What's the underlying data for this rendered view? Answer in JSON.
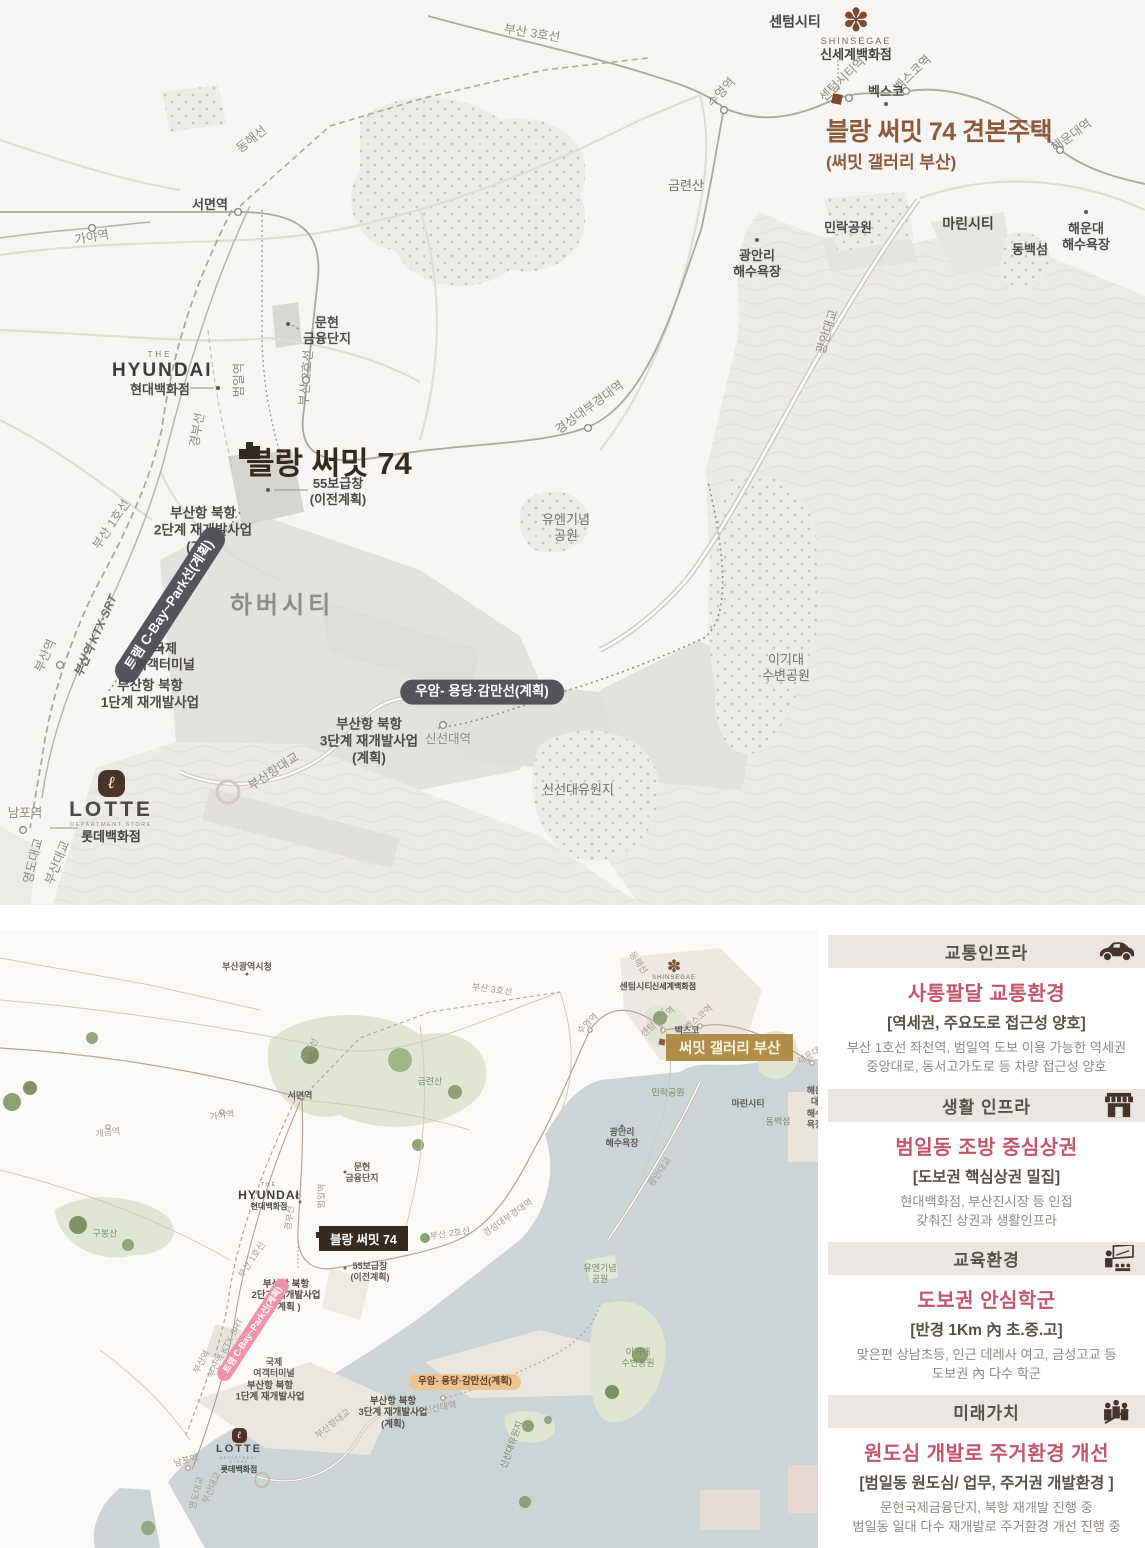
{
  "top_map": {
    "model_house": {
      "title": "블랑 써밋 74 견본주택",
      "subtitle": "(써밋 갤러리 부산)"
    },
    "summit_title": "블랑 써밋 74",
    "shinsegae": {
      "flower": "✽",
      "en": "SHINSEGAE",
      "kr": "신세계백화점"
    },
    "hyundai": {
      "the": "THE",
      "en": "HYUNDAI",
      "kr": "현대백화점"
    },
    "lotte": {
      "mark": "ℓ",
      "en": "LOTTE",
      "sub": "DEPARTMENT STORE",
      "kr": "롯데백화점"
    },
    "labels": [
      {
        "t": "부산 3호선",
        "x": 532,
        "y": 34,
        "c": "line",
        "r": 9
      },
      {
        "t": "수영역",
        "x": 722,
        "y": 93,
        "c": "st",
        "r": -48
      },
      {
        "t": "동해선",
        "x": 252,
        "y": 140,
        "c": "line",
        "r": -38
      },
      {
        "t": "센텀시티",
        "x": 795,
        "y": 22,
        "c": "place"
      },
      {
        "t": "센텀시티역",
        "x": 843,
        "y": 80,
        "c": "st",
        "r": -44
      },
      {
        "t": "벡스코역",
        "x": 913,
        "y": 74,
        "c": "st",
        "r": -44
      },
      {
        "t": "벡스코",
        "x": 886,
        "y": 92,
        "c": "place-sm"
      },
      {
        "t": "해운대역",
        "x": 1072,
        "y": 136,
        "c": "st",
        "r": -36
      },
      {
        "t": "가야역",
        "x": 92,
        "y": 238,
        "c": "st",
        "r": -10
      },
      {
        "t": "서면역",
        "x": 210,
        "y": 205,
        "c": "place-sm"
      },
      {
        "t": "금련산",
        "x": 686,
        "y": 186,
        "c": "park"
      },
      {
        "t": "민락공원",
        "x": 848,
        "y": 228,
        "c": "place-sm"
      },
      {
        "t": "광안리\n해수욕장",
        "x": 757,
        "y": 264,
        "c": "place-sm"
      },
      {
        "t": "마린시티",
        "x": 968,
        "y": 224,
        "c": "place"
      },
      {
        "t": "동백섬",
        "x": 1030,
        "y": 250,
        "c": "place-sm"
      },
      {
        "t": "해운대\n해수욕장",
        "x": 1086,
        "y": 237,
        "c": "place-sm"
      },
      {
        "t": "광안대교",
        "x": 828,
        "y": 332,
        "c": "line",
        "r": -73
      },
      {
        "t": "문현\n금융단지",
        "x": 327,
        "y": 331,
        "c": "place-sm"
      },
      {
        "t": "부산 2호선",
        "x": 307,
        "y": 378,
        "c": "line",
        "r": -85
      },
      {
        "t": "범일역",
        "x": 240,
        "y": 380,
        "c": "st",
        "r": -90
      },
      {
        "t": "경부선",
        "x": 198,
        "y": 430,
        "c": "line",
        "r": -80
      },
      {
        "t": "경성대부경대역",
        "x": 590,
        "y": 408,
        "c": "st",
        "r": -36
      },
      {
        "t": "55보급창\n(이전계획)",
        "x": 338,
        "y": 492,
        "c": "place-sm"
      },
      {
        "t": "부산항 북항\n2단계 재개발사업\n(계획)",
        "x": 203,
        "y": 531,
        "c": "proj"
      },
      {
        "t": "부산 1호선",
        "x": 112,
        "y": 525,
        "c": "line",
        "r": -56
      },
      {
        "t": "트램 C-Bay~Park선(계획)",
        "x": 170,
        "y": 605,
        "c": "pill-dark",
        "r": -57,
        "n": "tram-line-pill"
      },
      {
        "t": "하버시티",
        "x": 282,
        "y": 606,
        "c": "place-lg"
      },
      {
        "t": "국제\n여객터미널",
        "x": 165,
        "y": 657,
        "c": "place-sm"
      },
      {
        "t": "부산항 북항\n1단계 재개발사업",
        "x": 150,
        "y": 695,
        "c": "proj"
      },
      {
        "t": "부산역 KTX·SRT",
        "x": 96,
        "y": 636,
        "c": "st-i",
        "r": -66
      },
      {
        "t": "부산역",
        "x": 46,
        "y": 656,
        "c": "st",
        "r": -66
      },
      {
        "t": "유엔기념\n공원",
        "x": 566,
        "y": 528,
        "c": "park"
      },
      {
        "t": "이기대\n수변공원",
        "x": 786,
        "y": 668,
        "c": "park"
      },
      {
        "t": "우암- 용당·감만선(계획)",
        "x": 482,
        "y": 692,
        "c": "pill-dark",
        "n": "uam-line-pill"
      },
      {
        "t": "부산항 북항\n3단계 재개발사업\n(계획)",
        "x": 369,
        "y": 742,
        "c": "proj"
      },
      {
        "t": "신선대역",
        "x": 448,
        "y": 740,
        "c": "st"
      },
      {
        "t": "신선대유원지",
        "x": 578,
        "y": 790,
        "c": "park"
      },
      {
        "t": "남포역",
        "x": 25,
        "y": 814,
        "c": "st"
      },
      {
        "t": "영도대교",
        "x": 34,
        "y": 861,
        "c": "st",
        "r": -76
      },
      {
        "t": "부산대교",
        "x": 58,
        "y": 863,
        "c": "st",
        "r": -68
      },
      {
        "t": "부산항대교",
        "x": 274,
        "y": 772,
        "c": "line",
        "r": -33
      }
    ]
  },
  "bottom_map": {
    "gallery_pill": "써밋 갤러리 부산",
    "summit_pill": "블랑 써밋 74",
    "shinsegae": {
      "flower": "✽",
      "en": "SHINSEGAE",
      "kr": "신세계백화점"
    },
    "hyundai": {
      "the": "THE",
      "en": "HYUNDAI",
      "kr": "현대백화점"
    },
    "lotte": {
      "mark": "ℓ",
      "en": "LOTTE",
      "sub": "DEPARTMENT STORE",
      "kr": "롯데백화점"
    },
    "labels": [
      {
        "t": "부산광역시청",
        "x": 247,
        "y": 37,
        "c": "tiny-d"
      },
      {
        "t": "부산 3호선",
        "x": 492,
        "y": 60,
        "c": "tiny",
        "r": 8
      },
      {
        "t": "동해선",
        "x": 310,
        "y": 120,
        "c": "tiny",
        "r": -60
      },
      {
        "t": "수영역",
        "x": 588,
        "y": 94,
        "c": "tiny",
        "r": -45
      },
      {
        "t": "동해선",
        "x": 638,
        "y": 33,
        "c": "tiny",
        "r": 55
      },
      {
        "t": "센텀시티",
        "x": 636,
        "y": 57,
        "c": "tiny-d"
      },
      {
        "t": "센텀시티역",
        "x": 658,
        "y": 92,
        "c": "tiny",
        "r": -40
      },
      {
        "t": "벡스코역",
        "x": 699,
        "y": 88,
        "c": "tiny",
        "r": -40
      },
      {
        "t": "벡스코",
        "x": 687,
        "y": 101,
        "c": "tiny-d"
      },
      {
        "t": "해운대역",
        "x": 813,
        "y": 124,
        "c": "tiny",
        "r": -30
      },
      {
        "t": "금련산",
        "x": 430,
        "y": 152,
        "c": "tiny-g"
      },
      {
        "t": "개금역",
        "x": 108,
        "y": 203,
        "c": "tiny",
        "r": -8
      },
      {
        "t": "가야역",
        "x": 222,
        "y": 186,
        "c": "tiny",
        "r": -8
      },
      {
        "t": "서면역",
        "x": 300,
        "y": 166,
        "c": "tiny-d"
      },
      {
        "t": "구봉산",
        "x": 105,
        "y": 304,
        "c": "tiny-g"
      },
      {
        "t": "문현\n금융단지",
        "x": 362,
        "y": 243,
        "c": "tiny-d"
      },
      {
        "t": "경부선",
        "x": 290,
        "y": 288,
        "c": "tiny",
        "r": -82
      },
      {
        "t": "범일역",
        "x": 322,
        "y": 266,
        "c": "tiny",
        "r": -88
      },
      {
        "t": "부산 2호선",
        "x": 450,
        "y": 304,
        "c": "tiny",
        "r": -8
      },
      {
        "t": "경성대부경대역",
        "x": 508,
        "y": 288,
        "c": "tiny",
        "r": -35
      },
      {
        "t": "55보급창\n(이전계획)",
        "x": 370,
        "y": 342,
        "c": "tiny-d"
      },
      {
        "t": "부산 1호선",
        "x": 252,
        "y": 330,
        "c": "tiny",
        "r": -56
      },
      {
        "t": "부산항 북항\n2단계 재개발사업\n( 계획 )",
        "x": 286,
        "y": 366,
        "c": "tiny-p"
      },
      {
        "t": "유엔기념\n공원",
        "x": 600,
        "y": 344,
        "c": "tiny-g"
      },
      {
        "t": "트램 C-Bay~Park선(계획)",
        "x": 253,
        "y": 400,
        "c": "pill-pink",
        "r": -57,
        "n": "tram-line-pill"
      },
      {
        "t": "부산역 KTX·SRT",
        "x": 226,
        "y": 418,
        "c": "tiny",
        "r": -62
      },
      {
        "t": "부산역",
        "x": 202,
        "y": 432,
        "c": "tiny",
        "r": -62
      },
      {
        "t": "국제\n여객터미널",
        "x": 274,
        "y": 438,
        "c": "tiny-d"
      },
      {
        "t": "부산항 북항\n1단계 재개발사업",
        "x": 270,
        "y": 462,
        "c": "tiny-p"
      },
      {
        "t": "이기대\n수변공원",
        "x": 638,
        "y": 428,
        "c": "tiny-g"
      },
      {
        "t": "민락공원",
        "x": 668,
        "y": 163,
        "c": "tiny-g"
      },
      {
        "t": "광안리\n해수욕장",
        "x": 622,
        "y": 208,
        "c": "tiny-d"
      },
      {
        "t": "마린시티",
        "x": 748,
        "y": 174,
        "c": "tiny-d"
      },
      {
        "t": "동백섬",
        "x": 778,
        "y": 192,
        "c": "tiny-g"
      },
      {
        "t": "해운대\n해수욕장",
        "x": 815,
        "y": 178,
        "c": "tiny-d"
      },
      {
        "t": "광안대교",
        "x": 660,
        "y": 242,
        "c": "tiny",
        "r": -55
      },
      {
        "t": "우암- 용당·감만선(계획)",
        "x": 465,
        "y": 452,
        "c": "pill-tan",
        "n": "uam-line-pill"
      },
      {
        "t": "부산항 북항\n3단계 재개발사업\n(계획)",
        "x": 393,
        "y": 483,
        "c": "tiny-p"
      },
      {
        "t": "신선대역",
        "x": 440,
        "y": 478,
        "c": "tiny",
        "r": -10
      },
      {
        "t": "신선대유원지",
        "x": 512,
        "y": 515,
        "c": "tiny-g",
        "r": -70
      },
      {
        "t": "남포역",
        "x": 186,
        "y": 531,
        "c": "tiny",
        "r": -15
      },
      {
        "t": "영도대교",
        "x": 197,
        "y": 563,
        "c": "tiny",
        "r": -76
      },
      {
        "t": "부산대교",
        "x": 212,
        "y": 558,
        "c": "tiny",
        "r": -66
      },
      {
        "t": "부산항대교",
        "x": 333,
        "y": 494,
        "c": "tiny",
        "r": -38
      }
    ]
  },
  "panels": [
    {
      "header": "교통인프라",
      "icon": "car-icon",
      "title": "사통팔달 교통환경",
      "subtitle": "[역세권, 주요도로 접근성 양호]",
      "body": "부산 1호선 좌천역, 범일역 도보 이용 가능한 역세권\n중앙대로, 동서고가도로 등 차량 접근성 양호"
    },
    {
      "header": "생활 인프라",
      "icon": "store-icon",
      "title": "범일동 조방 중심상권",
      "subtitle": "[도보권 핵심상권 밀집]",
      "body": "현대백화점, 부산진시장 등 인접\n갖춰진 상권과 생활인프라"
    },
    {
      "header": "교육환경",
      "icon": "education-icon",
      "title": "도보권 안심학군",
      "subtitle": "[반경 1Km 內 초.중.고]",
      "body": "맞은편 상남초등, 인근 데레사 여고, 금성고교 등\n도보권 內 다수 학군"
    },
    {
      "header": "미래가치",
      "icon": "growth-icon",
      "title": "원도심 개발로 주거환경 개선",
      "subtitle": "[범일동 원도심/ 업무, 주거권 개발환경 ]",
      "body": "문현국제금융단지, 북항 재개발 진행 중\n범일동 일대 다수 재개발로 주거환경 개선 진행 중"
    }
  ],
  "colors": {
    "accent_brown": "#8e5a3d",
    "dark_brown": "#352a20",
    "panel_title_rose": "#c2566a",
    "gold_pill": "#b08d4b",
    "sea_top": "#edebe8",
    "sea_bottom": "#cdd4d5"
  }
}
